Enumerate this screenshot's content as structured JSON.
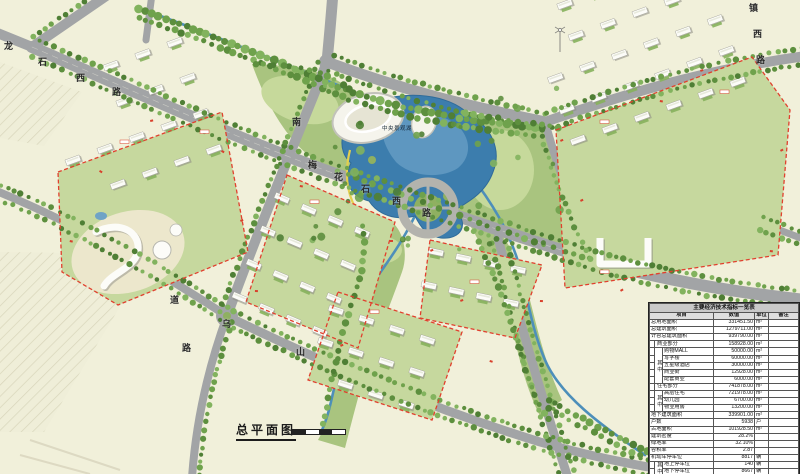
{
  "plan_title": "总平面图",
  "map": {
    "lake_label": "中央景观湖",
    "road_chars": [
      {
        "c": "龙",
        "x": 4,
        "y": 42
      },
      {
        "c": "石",
        "x": 38,
        "y": 58
      },
      {
        "c": "西",
        "x": 76,
        "y": 74
      },
      {
        "c": "路",
        "x": 112,
        "y": 88
      },
      {
        "c": "梅",
        "x": 308,
        "y": 161
      },
      {
        "c": "花",
        "x": 334,
        "y": 173
      },
      {
        "c": "石",
        "x": 361,
        "y": 185
      },
      {
        "c": "西",
        "x": 392,
        "y": 197
      },
      {
        "c": "路",
        "x": 422,
        "y": 209
      },
      {
        "c": "南",
        "x": 292,
        "y": 118
      },
      {
        "c": "道",
        "x": 170,
        "y": 296
      },
      {
        "c": "路",
        "x": 182,
        "y": 344
      },
      {
        "c": "乌",
        "x": 222,
        "y": 320
      },
      {
        "c": "山",
        "x": 296,
        "y": 348
      },
      {
        "c": "镇",
        "x": 749,
        "y": 4
      },
      {
        "c": "西",
        "x": 753,
        "y": 30
      },
      {
        "c": "路",
        "x": 756,
        "y": 56
      }
    ]
  },
  "table": {
    "title": "主要经济技术指标一览表",
    "headers": [
      "项目",
      "数值",
      "单位",
      "备注"
    ],
    "among_label": "其中",
    "rows": [
      {
        "label": "总用地面积",
        "value": "331451.50",
        "unit": "m²",
        "lvl": 0
      },
      {
        "label": "总建筑面积",
        "value": "1279711.00",
        "unit": "m²",
        "lvl": 0
      },
      {
        "label": "计容总建筑面积",
        "value": "939790.00",
        "unit": "m²",
        "lvl": 0
      },
      {
        "label": "商业部分",
        "value": "158928.00",
        "unit": "m²",
        "lvl": 1
      },
      {
        "label": "购物MALL",
        "value": "50000.00",
        "unit": "m²",
        "lvl": 2,
        "qz": 5
      },
      {
        "label": "写字楼",
        "value": "60000.00",
        "unit": "m²",
        "lvl": 2
      },
      {
        "label": "五星级酒店",
        "value": "30000.00",
        "unit": "m²",
        "lvl": 2
      },
      {
        "label": "商业街",
        "value": "12928.00",
        "unit": "m²",
        "lvl": 2
      },
      {
        "label": "配套商业",
        "value": "6000.00",
        "unit": "m²",
        "lvl": 2
      },
      {
        "label": "住宅部分",
        "value": "741878.00",
        "unit": "m²",
        "lvl": 1
      },
      {
        "label": "高层住宅",
        "value": "721978.00",
        "unit": "m²",
        "lvl": 2,
        "qz": 3
      },
      {
        "label": "幼儿园",
        "value": "6700.00",
        "unit": "m²",
        "lvl": 2
      },
      {
        "label": "物业用房",
        "value": "13200.00",
        "unit": "m²",
        "lvl": 2
      },
      {
        "label": "地下建筑面积",
        "value": "339901.00",
        "unit": "m²",
        "lvl": 0
      },
      {
        "label": "户数",
        "value": "5938",
        "unit": "户",
        "lvl": 0
      },
      {
        "label": "占地面积",
        "value": "101928.50",
        "unit": "m²",
        "lvl": 0
      },
      {
        "label": "建筑密度",
        "value": "28.2%",
        "unit": "",
        "lvl": 0
      },
      {
        "label": "绿地率",
        "value": "32.10%",
        "unit": "",
        "lvl": 0
      },
      {
        "label": "容积率",
        "value": "2.87",
        "unit": "",
        "lvl": 0
      },
      {
        "label": "机动车停车位",
        "value": "8817",
        "unit": "辆",
        "lvl": 0
      },
      {
        "label": "地上停车位",
        "value": "140",
        "unit": "辆",
        "lvl": 2,
        "qz": 2
      },
      {
        "label": "地下停车位",
        "value": "8667",
        "unit": "辆",
        "lvl": 2
      }
    ]
  }
}
